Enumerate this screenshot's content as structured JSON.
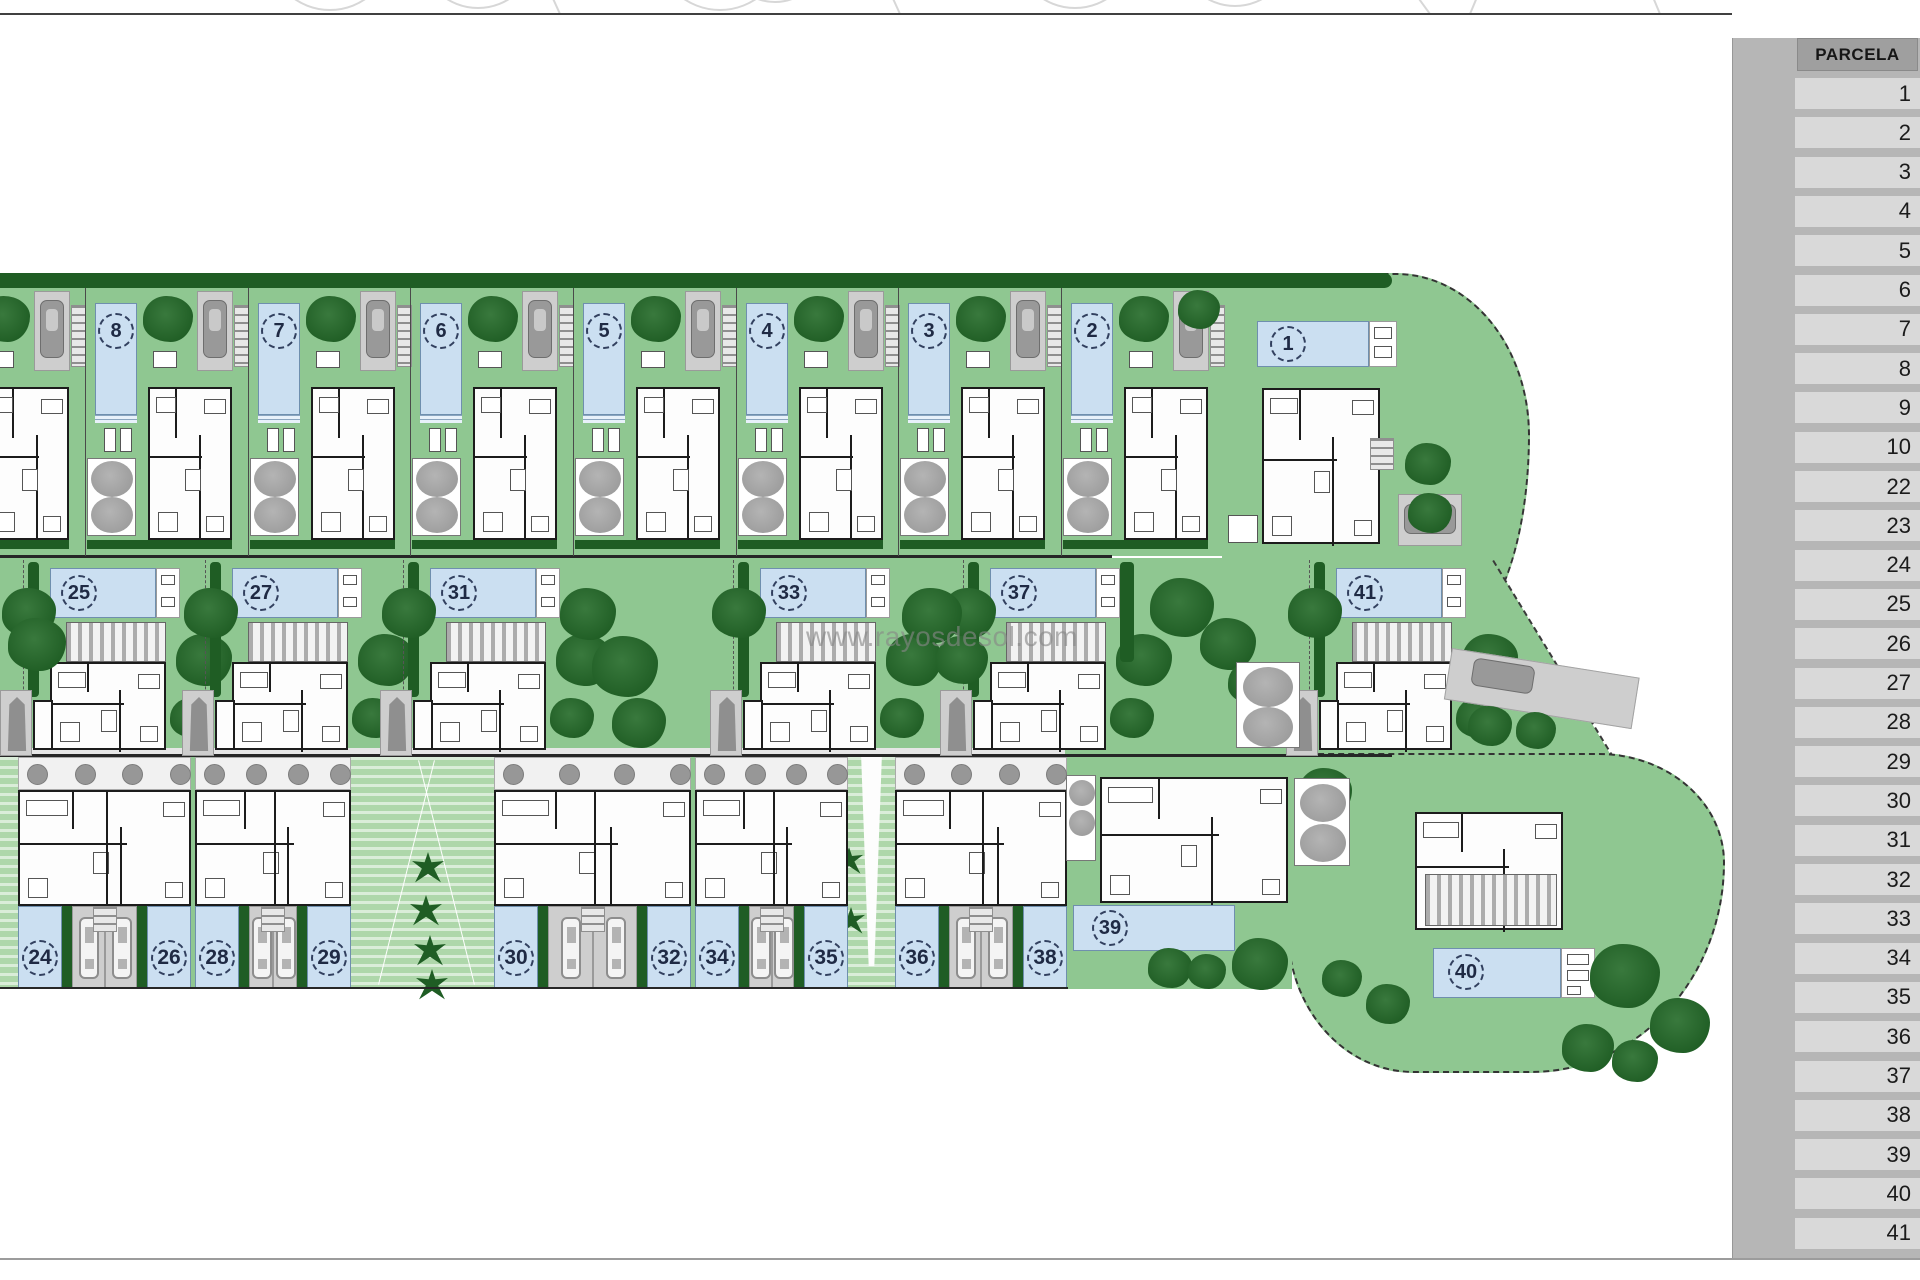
{
  "page": {
    "watermark": "www.rayosdesol.com"
  },
  "sidebar": {
    "header": "PARCELA",
    "rows": [
      "1",
      "2",
      "3",
      "4",
      "5",
      "6",
      "7",
      "8",
      "9",
      "10",
      "22",
      "23",
      "24",
      "25",
      "26",
      "27",
      "28",
      "29",
      "30",
      "31",
      "32",
      "33",
      "34",
      "35",
      "36",
      "37",
      "38",
      "39",
      "40",
      "41"
    ]
  },
  "plan": {
    "row1_plots": [
      "8",
      "7",
      "6",
      "5",
      "4",
      "3",
      "2"
    ],
    "plot_right_top": "1",
    "row2_plots": [
      "25",
      "27",
      "31",
      "33",
      "37",
      "41"
    ],
    "row3_buildings": [
      [
        "24",
        "26"
      ],
      [
        "28",
        "29"
      ],
      [
        "30",
        "32"
      ],
      [
        "34",
        "35"
      ],
      [
        "36",
        "38"
      ]
    ],
    "plot_39": "39",
    "plot_40": "40"
  },
  "colors": {
    "lawn": "#8fc791",
    "lawn_light": "#aed7aa",
    "hedge": "#1f5d24",
    "tree_light": "#39793d",
    "gray_tree": "#9d9d9d",
    "pool": "#cbdff1",
    "pool_border": "#6f8fae",
    "drive": "#cecece",
    "house_line": "#1c1c1c",
    "panel": "#b6b6b6",
    "header_bg": "#9f9f9f",
    "row_bg": "#d9d9d9",
    "number_text": "#1f2a44",
    "watermark": "#878787"
  }
}
